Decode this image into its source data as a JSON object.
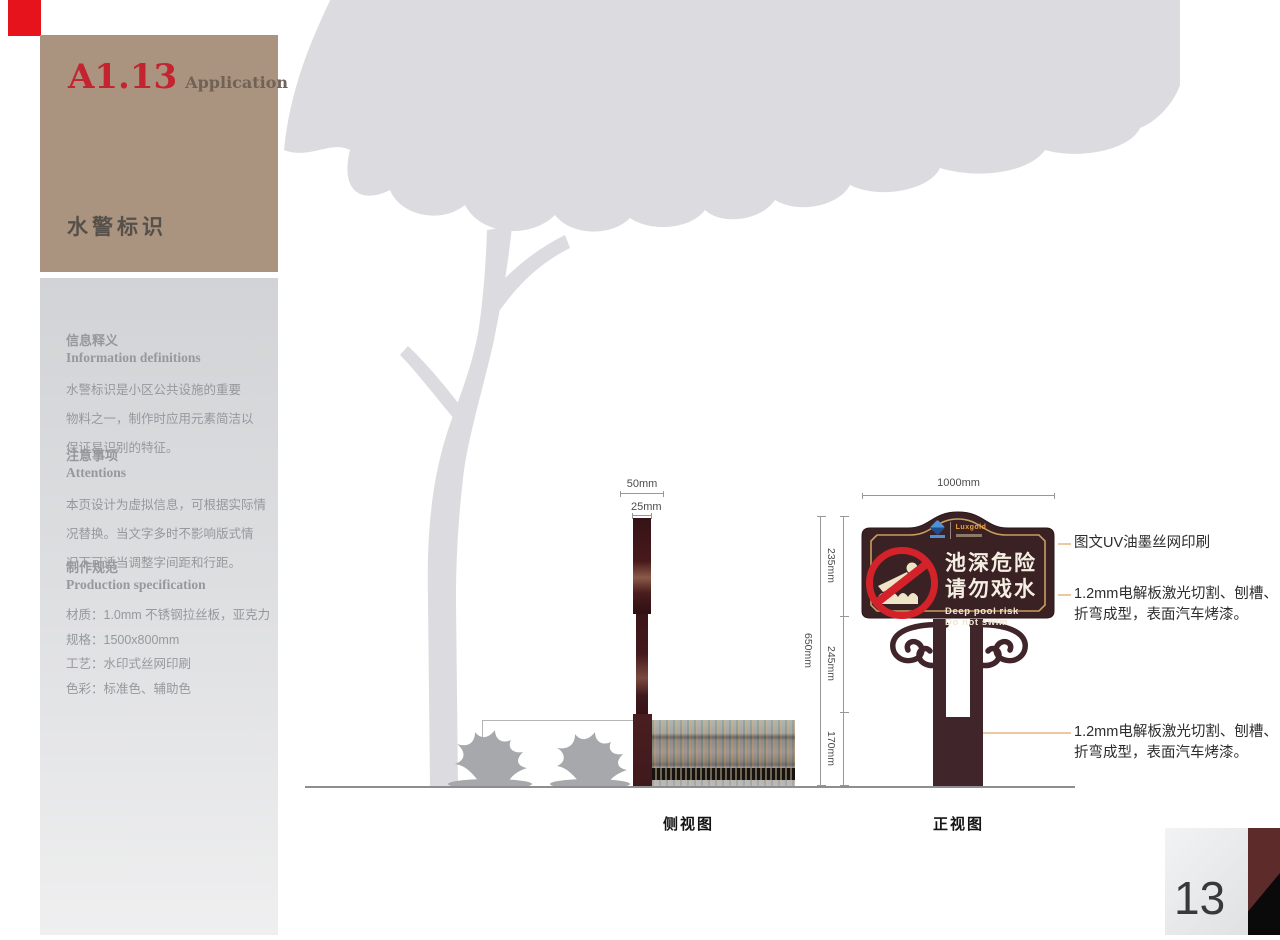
{
  "colors": {
    "accent_red": "#e6131d",
    "header_bg": "#ab947f",
    "code_red": "#c32430",
    "panel_text": "#96989c",
    "sign_brown": "#3a2124",
    "sign_gold": "#c79e62",
    "prohibition_red": "#d3222a",
    "post_brown": "#40252a",
    "footer_maroon": "#5d2b2a"
  },
  "header": {
    "code": "A1.13",
    "subtitle": "Application",
    "title": "水警标识"
  },
  "info_panel": {
    "sections": [
      {
        "heading_cn": "信息释义",
        "heading_en": "Information definitions",
        "lines": [
          "水警标识是小区公共设施的重要",
          "物料之一，制作时应用元素简洁以",
          "保证易识别的特征。"
        ]
      },
      {
        "heading_cn": "注意事项",
        "heading_en": "Attentions",
        "lines": [
          "本页设计为虚拟信息，可根据实际情",
          "况替换。当文字多时不影响版式情",
          "况下可适当调整字间距和行距。"
        ]
      },
      {
        "heading_cn": "制作规范",
        "heading_en": "Production specification",
        "lines": [
          "材质：1.0mm 不锈钢拉丝板，亚克力",
          "规格：1500x800mm",
          "工艺：水印式丝网印刷",
          "色彩：标准色、辅助色"
        ]
      }
    ]
  },
  "drawing": {
    "side_view": {
      "label": "侧视图",
      "dim_top": "50mm",
      "dim_post": "25mm"
    },
    "front_view": {
      "label": "正视图",
      "dim_width": "1000mm",
      "dim_total_height": "650mm",
      "dim_panel": "235mm",
      "dim_post": "245mm",
      "dim_base": "170mm",
      "sign": {
        "cn_line1": "池深危险",
        "cn_line2": "请勿戏水",
        "en_line1": "Deep pool risk",
        "en_line2": "Do not swim",
        "logo_wordmark": "Luxgold"
      }
    },
    "annotations": {
      "print": "图文UV油墨丝网印刷",
      "panel_line1": "1.2mm电解板激光切割、刨槽、",
      "panel_line2": "折弯成型，表面汽车烤漆。",
      "base_line1": "1.2mm电解板激光切割、刨槽、",
      "base_line2": "折弯成型，表面汽车烤漆。"
    }
  },
  "footer": {
    "page_number": "13"
  }
}
